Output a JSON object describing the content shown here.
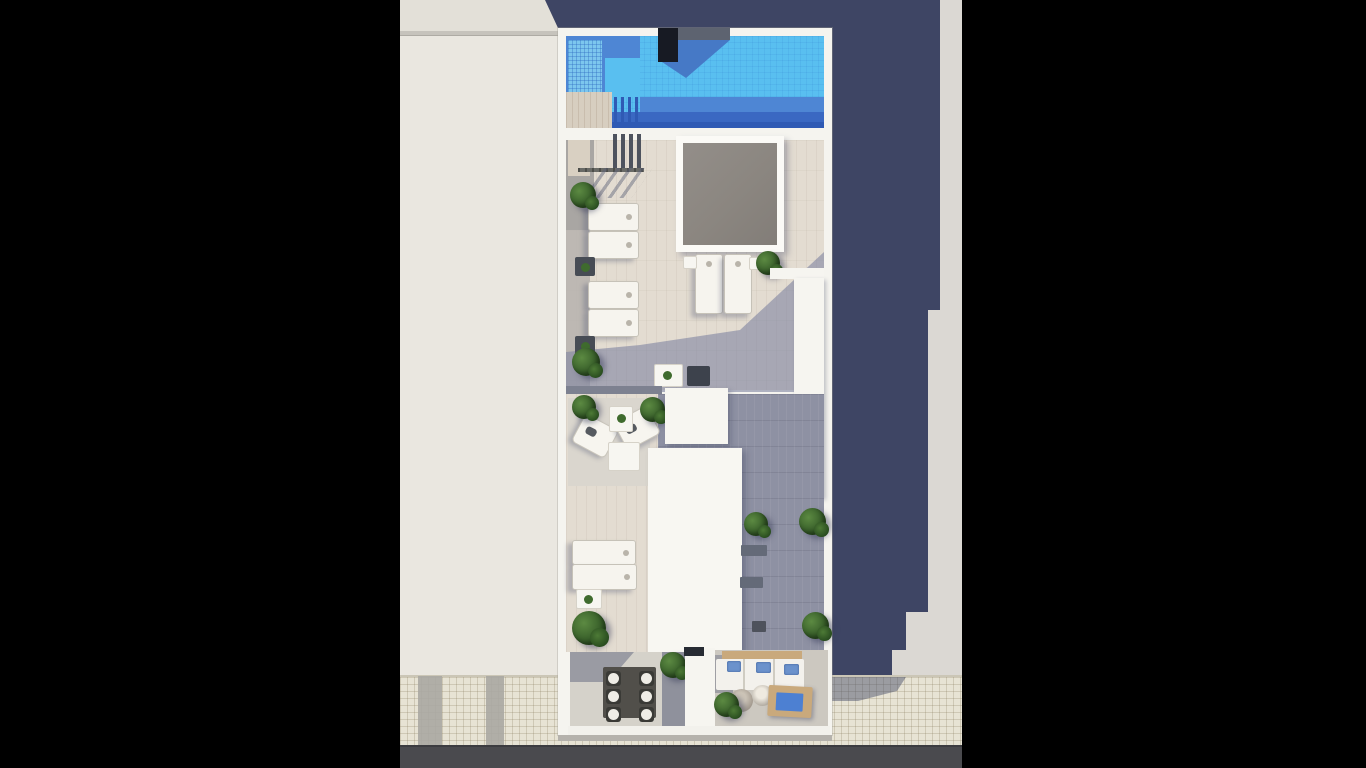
{
  "meta": {
    "image_type": "3D architectural rendering",
    "view": "top-down aerial view",
    "subject": "Rooftop terrace of a narrow residential building with swimming pool, sun deck, skylight, lounge furniture, planted balconies, adjacent rooftop, sidewalk and road; image pillarboxed with black bars",
    "text_content": "none"
  },
  "palette": {
    "letterbox": "#000000",
    "neighbor_roof": "#eae7e0",
    "ground_right": "#dbd8d3",
    "shadow_navy": "#3e4564",
    "sidewalk": "#e7e3d4",
    "road": "#4a4a4e",
    "building_white": "#f5f4ef",
    "pool_bright": "#59bff0",
    "pool_mid": "#4e86d4",
    "pool_dark": "#3a68c2",
    "pool_shelf": "#7cc6ee",
    "deck_wood_light": "#e3dcd1",
    "deck_wood_shaded": "#8e91a3",
    "skylight_gray": "#8b8680",
    "plant_green": "#3c662c",
    "sofa_wood": "#c9a97c",
    "cushion_blue": "#6b92cc",
    "daybed_blue": "#4d80d2"
  },
  "labels": {
    "photo": "Aerial 3D rendering of a rooftop terrace",
    "letterbox_left": "Black pillarbox bar (left)",
    "letterbox_right": "Black pillarbox bar (right)",
    "neighbor_roof": "Adjacent building rooftop",
    "building": "Main building rooftop",
    "pool": "Swimming pool",
    "pool_shelf": "Pool tanning shelf (tiled)",
    "pool_deck": "Pool-edge wooden deck with ladder steps",
    "chimney": "Rooftop chimney block",
    "skylight": "Skylight opening over lower floor",
    "stair_access": "Stair access with railing and pergola posts",
    "sun_lounger": "Sun lounger",
    "side_table": "Dark side table with plant",
    "white_table": "Small white table",
    "planter_wall": "White planter / parapet wall",
    "seating_area": "Lounge corner with two armchairs and coffee table",
    "coffee_table": "Coffee table",
    "stair_core_roof": "White roof of stair/elevator core",
    "vent": "Rooftop vent unit",
    "dining_balcony": "Balcony with dining table for six",
    "dining_table": "Rectangular dining table",
    "dining_chair": "Dining chair with round cushion",
    "sofa_balcony": "Balcony with outdoor sofa, poufs and daybed",
    "sofa": "Outdoor sofa with blue pillows",
    "pouf": "Round pouf",
    "daybed": "Wooden daybed with blue cushion",
    "plant": "Green potted plant",
    "building_shadow": "Shadow cast by the building",
    "sidewalk": "Tiled sidewalk",
    "driveway": "Driveway curb cut",
    "road": "Asphalt road"
  }
}
